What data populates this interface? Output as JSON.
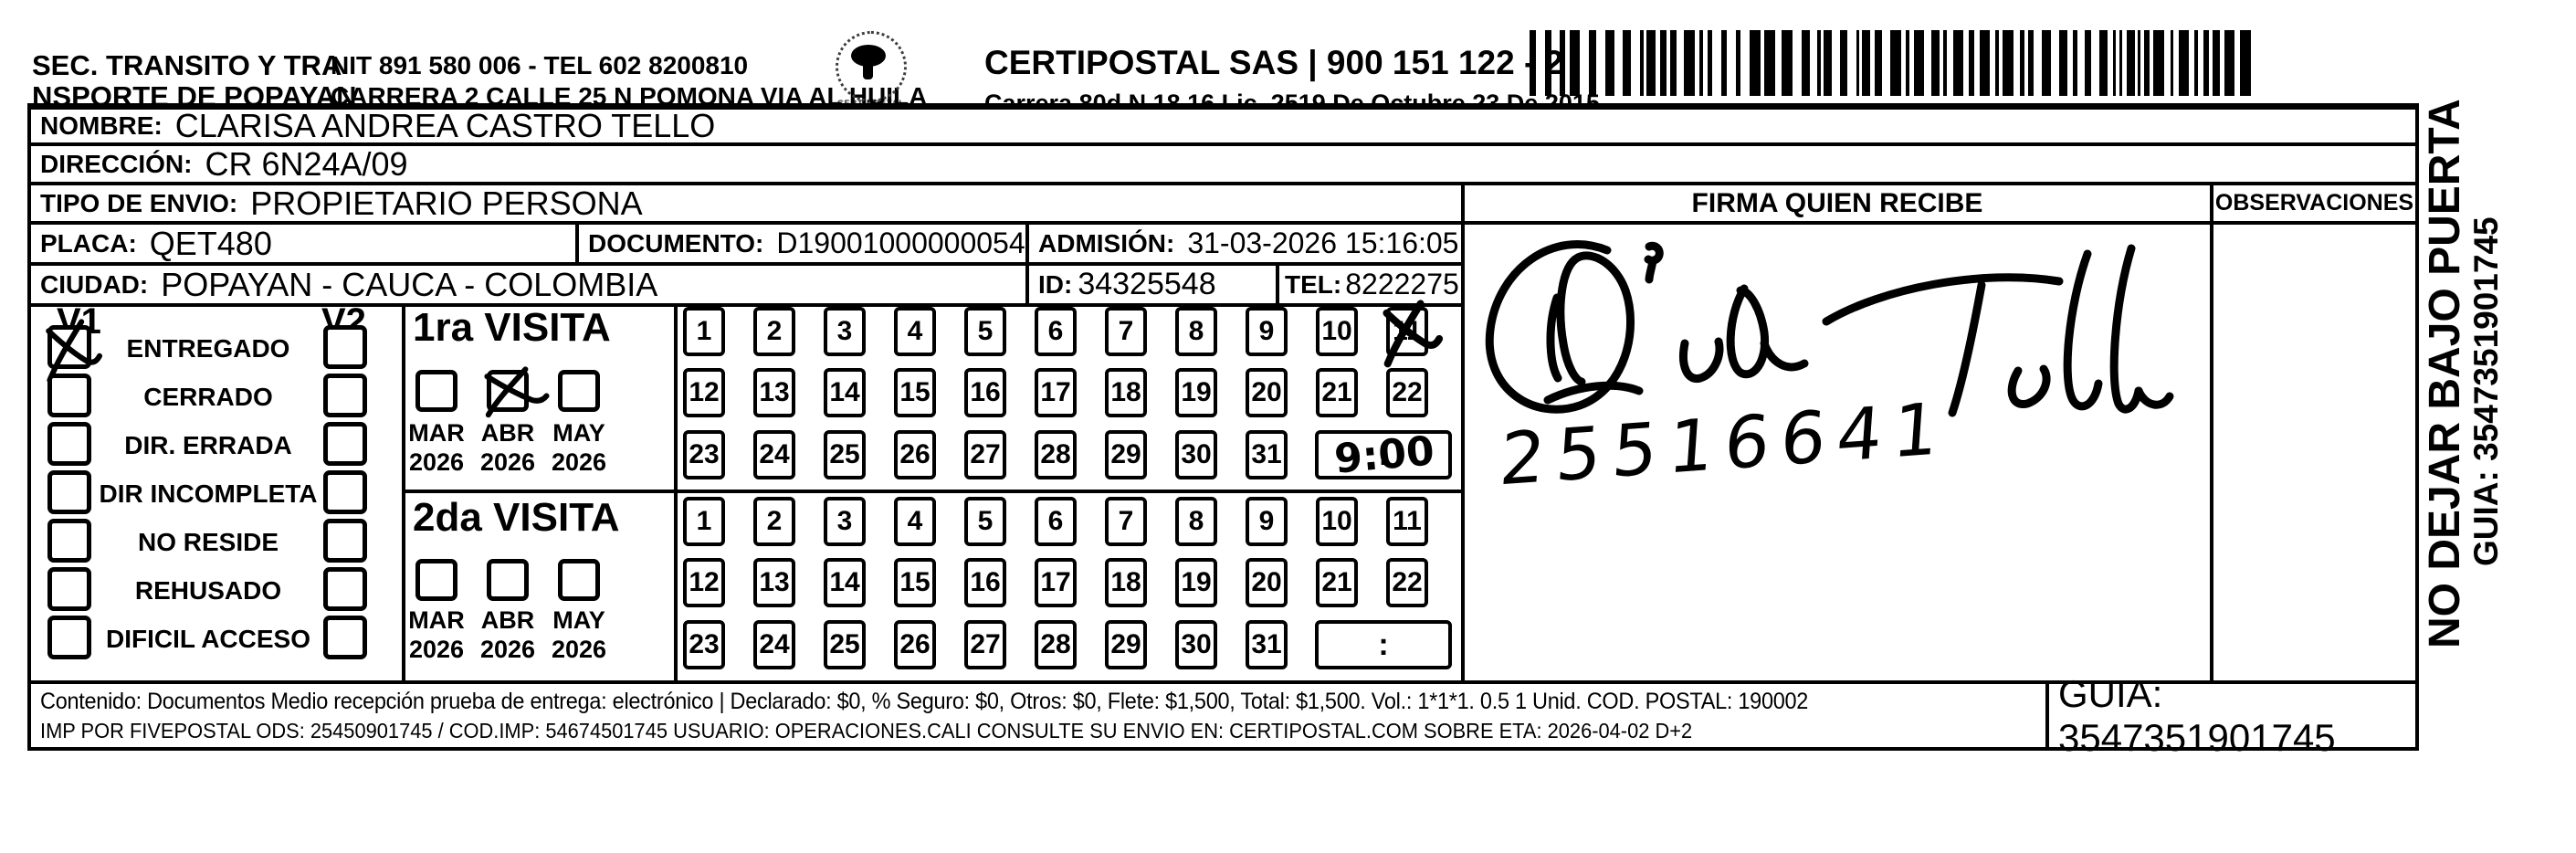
{
  "header": {
    "sender_line1": "SEC. TRANSITO Y TRA",
    "sender_line2": "NSPORTE DE POPAYAN",
    "nit_tel": "NIT 891 580 006 - TEL 602 8200810",
    "address": "CARRERA 2 CALLE 25 N POMONA VIA AL HUILA",
    "logo_text": "CERTIPOSTAL",
    "carrier_name": "CERTIPOSTAL SAS | 900 151 122 - 2",
    "carrier_lic": "Carrera 80d N 18 16  Lic. 2519 De Octubre 23 De 2015"
  },
  "recipient": {
    "nombre_label": "NOMBRE:",
    "nombre": "CLARISA ANDREA CASTRO TELLO",
    "direccion_label": "DIRECCIÓN:",
    "direccion": "CR 6N24A/09",
    "tipo_label": "TIPO DE ENVIO:",
    "tipo": "PROPIETARIO PERSONA",
    "placa_label": "PLACA:",
    "placa": "QET480",
    "documento_label": "DOCUMENTO:",
    "documento": "D19001000000054744713",
    "admision_label": "ADMISIÓN:",
    "admision": "31-03-2026 15:16:05",
    "ciudad_label": "CIUDAD:",
    "ciudad": "POPAYAN - CAUCA - COLOMBIA",
    "id_label": "ID:",
    "id": "34325548",
    "tel_label": "TEL:",
    "tel": "8222275"
  },
  "signature_block": {
    "firma_header": "FIRMA QUIEN RECIBE",
    "observaciones_header": "OBSERVACIONES",
    "signature_reads": "Cido Tello",
    "number": "25516641"
  },
  "delivery": {
    "v1_label": "V1",
    "v2_label": "V2",
    "time_separator": ":",
    "statuses": [
      {
        "label": "ENTREGADO",
        "v1_checked": true,
        "v2_checked": false
      },
      {
        "label": "CERRADO",
        "v1_checked": false,
        "v2_checked": false
      },
      {
        "label": "DIR. ERRADA",
        "v1_checked": false,
        "v2_checked": false
      },
      {
        "label": "DIR INCOMPLETA",
        "v1_checked": false,
        "v2_checked": false
      },
      {
        "label": "NO RESIDE",
        "v1_checked": false,
        "v2_checked": false
      },
      {
        "label": "REHUSADO",
        "v1_checked": false,
        "v2_checked": false
      },
      {
        "label": "DIFICIL ACCESO",
        "v1_checked": false,
        "v2_checked": false
      }
    ],
    "visits": [
      {
        "title": "1ra VISITA",
        "months": [
          {
            "label": "MAR",
            "year": "2026",
            "checked": false
          },
          {
            "label": "ABR",
            "year": "2026",
            "checked": true
          },
          {
            "label": "MAY",
            "year": "2026",
            "checked": false
          }
        ],
        "days": [
          1,
          2,
          3,
          4,
          5,
          6,
          7,
          8,
          9,
          10,
          11,
          12,
          13,
          14,
          15,
          16,
          17,
          18,
          19,
          20,
          21,
          22,
          23,
          24,
          25,
          26,
          27,
          28,
          29,
          30,
          31
        ],
        "crossed_days": [
          11
        ],
        "time": "9:00"
      },
      {
        "title": "2da VISITA",
        "months": [
          {
            "label": "MAR",
            "year": "2026",
            "checked": false
          },
          {
            "label": "ABR",
            "year": "2026",
            "checked": false
          },
          {
            "label": "MAY",
            "year": "2026",
            "checked": false
          }
        ],
        "days": [
          1,
          2,
          3,
          4,
          5,
          6,
          7,
          8,
          9,
          10,
          11,
          12,
          13,
          14,
          15,
          16,
          17,
          18,
          19,
          20,
          21,
          22,
          23,
          24,
          25,
          26,
          27,
          28,
          29,
          30,
          31
        ],
        "crossed_days": [],
        "time": ""
      }
    ]
  },
  "footer": {
    "content_line": "Contenido: Documentos Medio recepción prueba de entrega: electrónico | Declarado: $0, % Seguro: $0, Otros: $0, Flete: $1,500, Total: $1,500. Vol.: 1*1*1. 0.5  1 Unid. COD. POSTAL: 190002",
    "imp_line": "IMP POR FIVEPOSTAL ODS: 25450901745 / COD.IMP: 54674501745 USUARIO: OPERACIONES.CALI CONSULTE SU ENVIO EN: CERTIPOSTAL.COM SOBRE ETA: 2026-04-02 D+2",
    "guia": "GUIA: 3547351901745"
  },
  "side": {
    "warning": "NO DEJAR BAJO PUERTA",
    "guia": "GUIA: 3547351901745"
  }
}
